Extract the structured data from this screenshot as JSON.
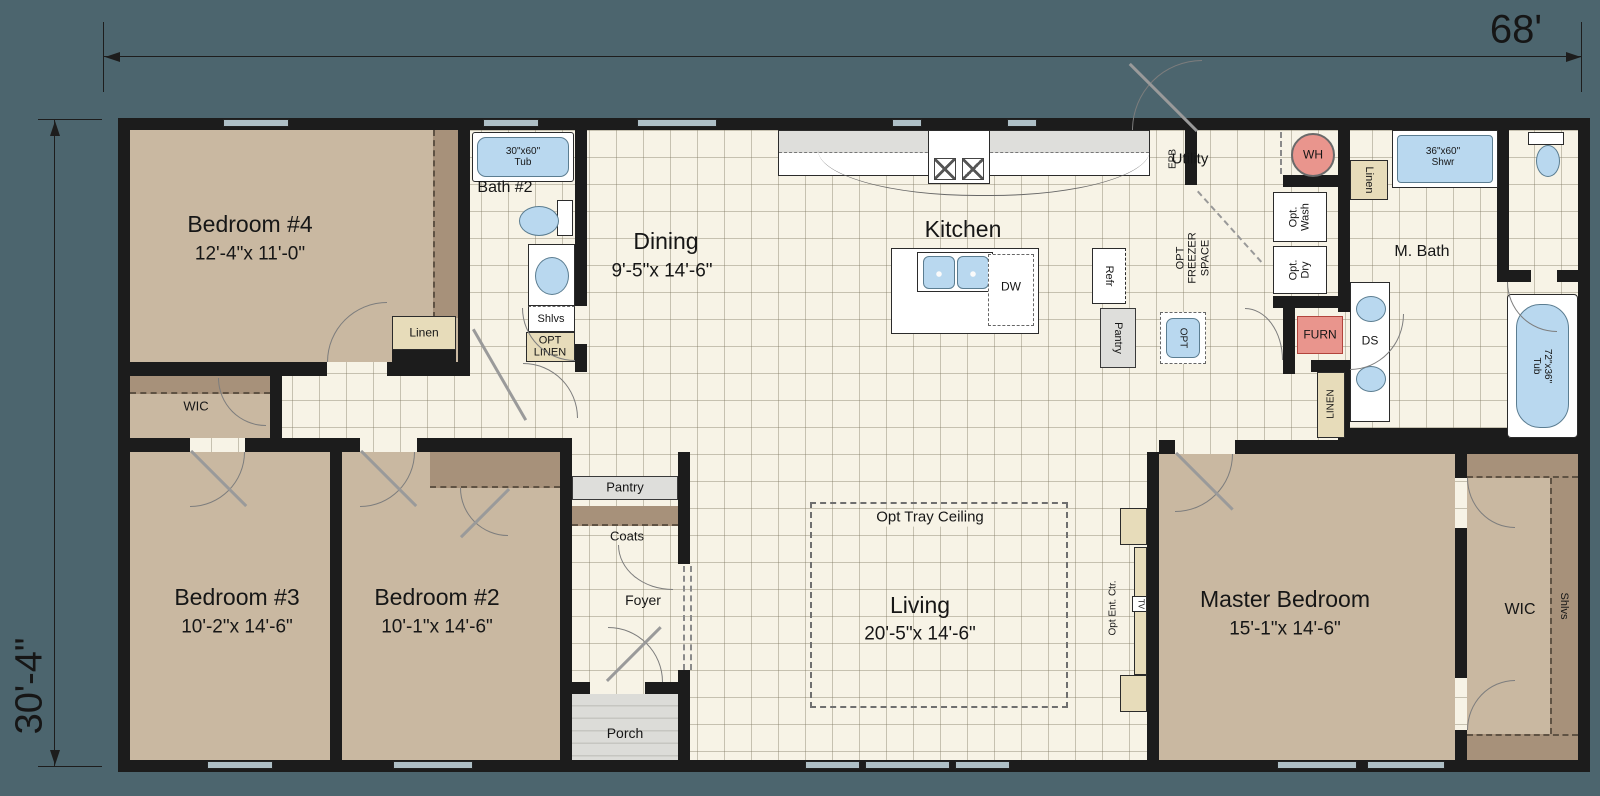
{
  "colors": {
    "bg": "#4c656e",
    "tile": "#f7f3e6",
    "carpet": "#c9b8a1",
    "carpetdark": "#a7917a",
    "wall": "#1c1c1c",
    "blue": "#b9d8ef",
    "pink": "#e9958d",
    "gray": "#dededb",
    "tan": "#e7dcba"
  },
  "dim": {
    "width": "68'",
    "depth": "30'-4\""
  },
  "rooms": {
    "bedroom4": {
      "name": "Bedroom #4",
      "size": "12'-4\"x 11'-0\""
    },
    "bedroom3": {
      "name": "Bedroom #3",
      "size": "10'-2\"x 14'-6\""
    },
    "bedroom2": {
      "name": "Bedroom #2",
      "size": "10'-1\"x 14'-6\""
    },
    "master": {
      "name": "Master Bedroom",
      "size": "15'-1\"x 14'-6\""
    },
    "dining": {
      "name": "Dining",
      "size": "9'-5\"x 14'-6\""
    },
    "living": {
      "name": "Living",
      "size": "20'-5\"x 14'-6\"",
      "tray": "Opt Tray Ceiling"
    },
    "kitchen": {
      "name": "Kitchen"
    },
    "utility": {
      "name": "Utility"
    },
    "bath2": {
      "name": "Bath #2"
    },
    "mbath": {
      "name": "M. Bath"
    },
    "wic_left": {
      "name": "WIC"
    },
    "wic_master": {
      "name": "WIC"
    },
    "foyer": {
      "name": "Foyer"
    },
    "porch": {
      "name": "Porch"
    }
  },
  "closets": {
    "linen_hall": "Linen",
    "opt_linen": "OPT\nLINEN",
    "shlvs_bath2": "Shlvs",
    "pantry_foyer": "Pantry",
    "coats": "Coats",
    "linen_mbath": "Linen",
    "linen_tall": "LINEN",
    "shlvs_wic": "Shlvs",
    "pantry_kitchen": "Pantry"
  },
  "fixtures": {
    "tub_bath2": "30\"x60\"\nTub",
    "shower": "36\"x60\"\nShwr",
    "tub_master": "72\"x36\"\nTub",
    "double_sink": "DS",
    "dishwasher": "DW",
    "refrigerator": "Refr",
    "opt_sink": "OPT",
    "water_heater": "WH",
    "furnace": "FURN",
    "epb": "EPB",
    "opt_wash": "Opt.\nWash",
    "opt_dry": "Opt.\nDry",
    "opt_freezer": "OPT\nFREEZER\nSPACE",
    "opt_ent": "Opt Ent. Ctr.",
    "tv": "TV"
  }
}
